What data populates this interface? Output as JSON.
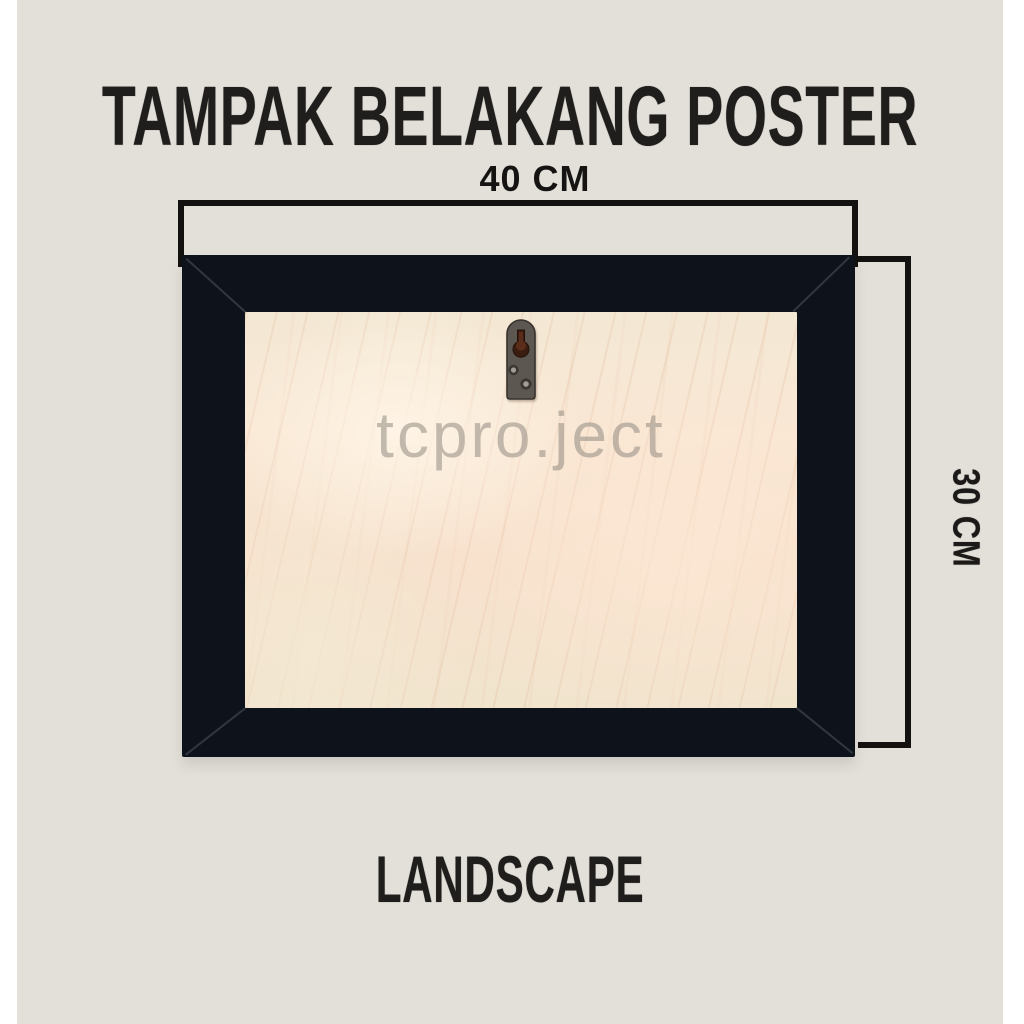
{
  "header": {
    "title": "TAMPAK BELAKANG POSTER"
  },
  "diagram": {
    "width_dimension": {
      "label": "40 CM"
    },
    "height_dimension": {
      "label": "30 CM"
    },
    "watermark": "tcpro.ject",
    "hanger_icon": "keyhole-hanger"
  },
  "footer": {
    "orientation_label": "LANDSCAPE"
  },
  "colors": {
    "page_background": "#ffffff",
    "canvas_background": "#e3e0d9",
    "frame": "#0e131b",
    "board": "#f7e5d2",
    "text": "#201e1c",
    "dimension_line": "#141210",
    "watermark": "#928b82",
    "hanger_metal": "#5d5751",
    "keyhole": "#4a2316"
  }
}
